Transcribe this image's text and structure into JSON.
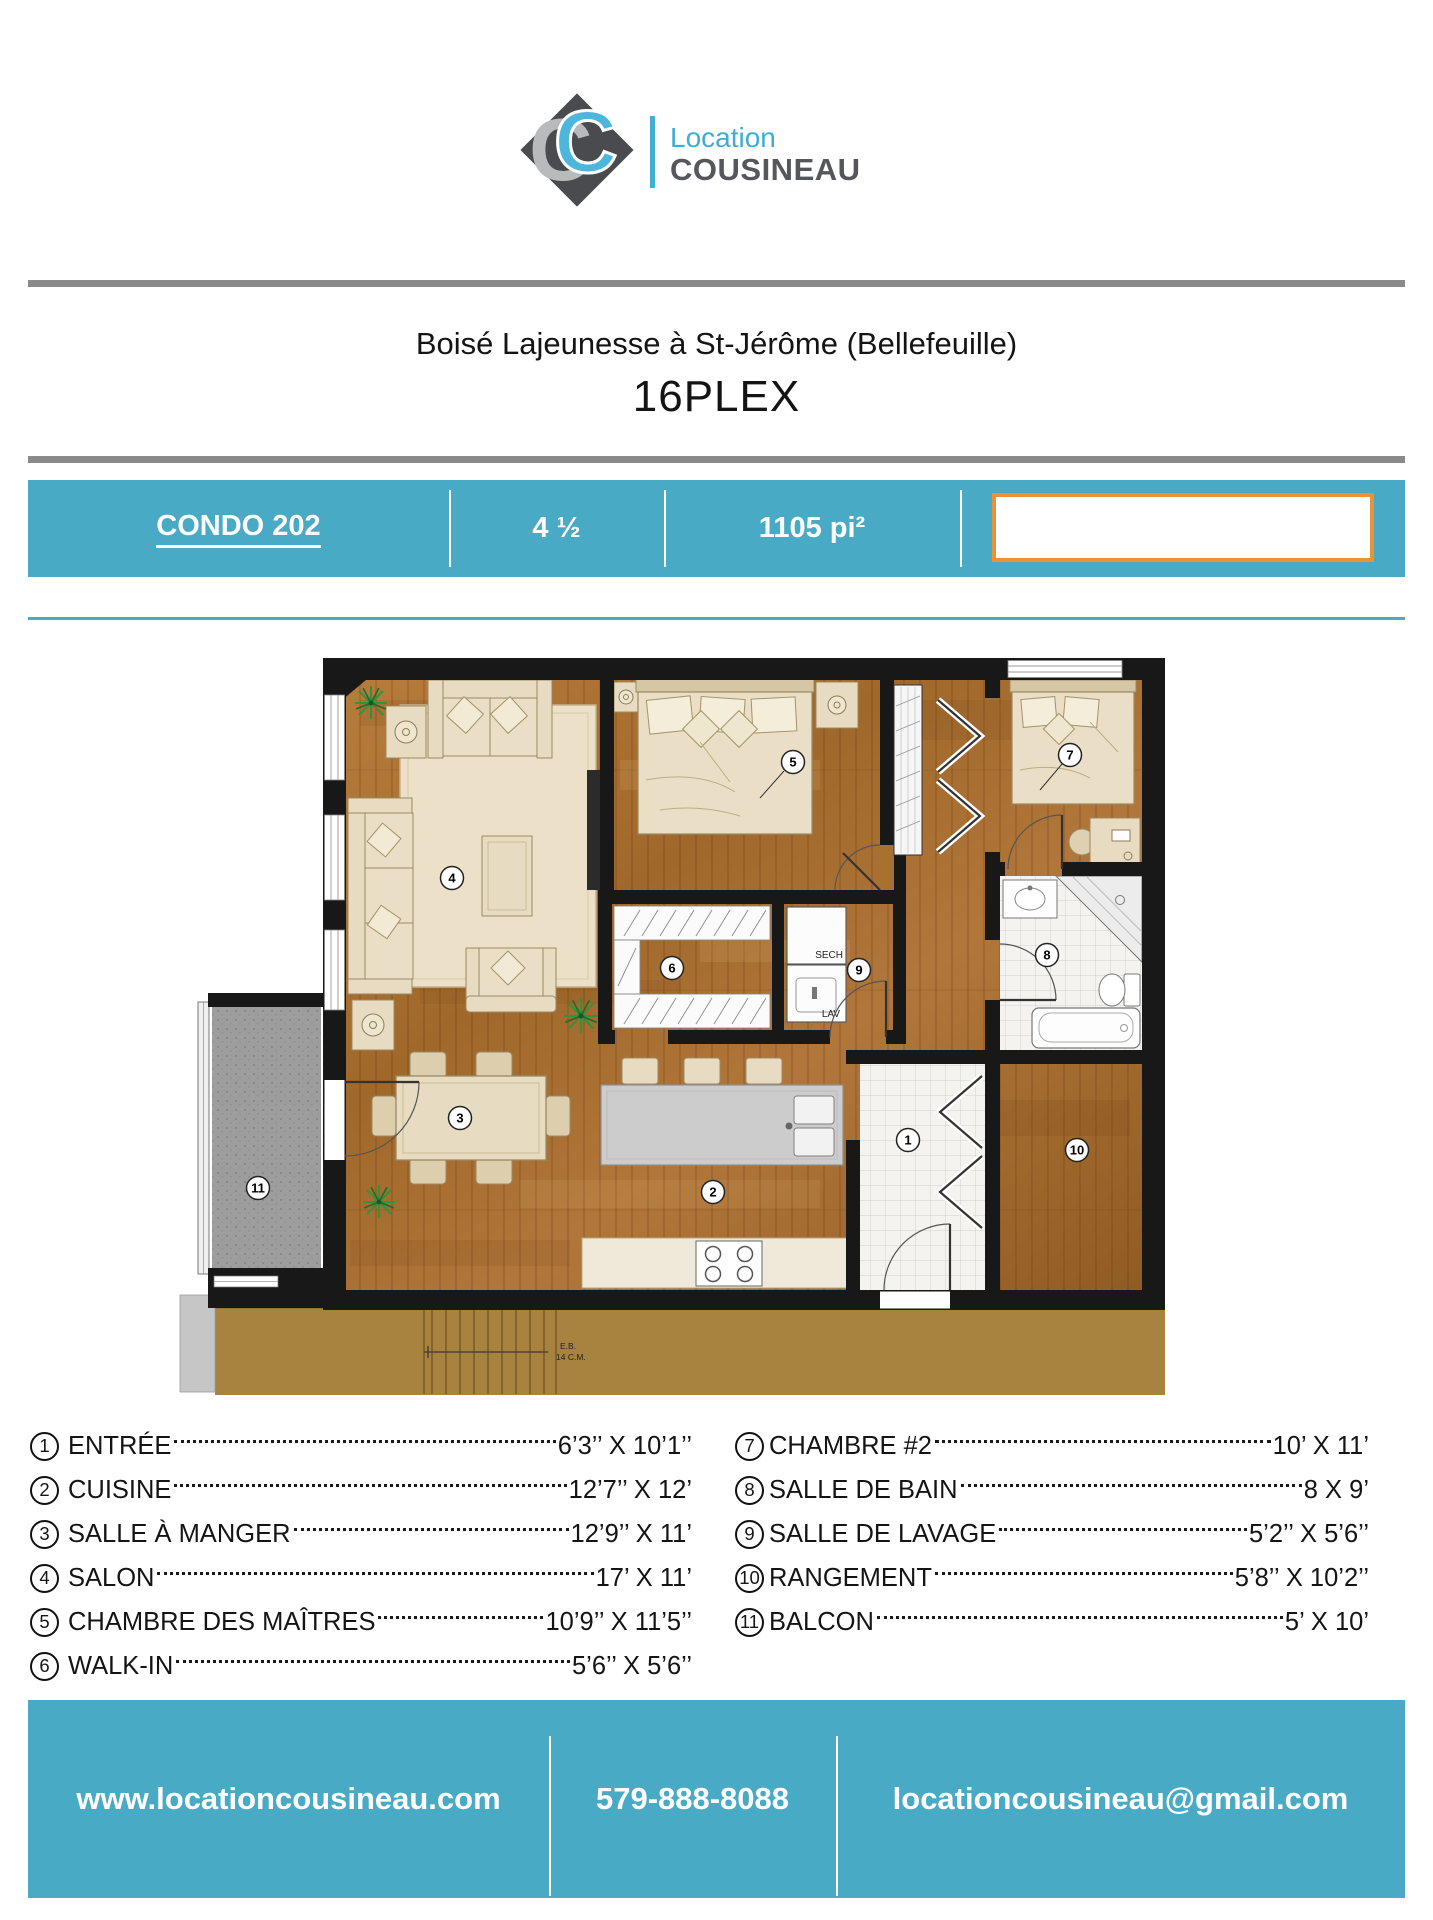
{
  "logo": {
    "monogram_back": "C",
    "monogram_front": "C",
    "brand_line1": "Location",
    "brand_line2": "COUSINEAU"
  },
  "title": {
    "line1": "Boisé Lajeunesse à St-Jérôme (Bellefeuille)",
    "line2": "16PLEX"
  },
  "banner": {
    "unit": "CONDO 202",
    "size": "4 ½",
    "area": "1105 pi²"
  },
  "floorplan": {
    "labels": {
      "dryer": "SECH",
      "washer": "LAV",
      "stair_note_1": "E.B.",
      "stair_note_2": "14 C.M."
    },
    "rooms": [
      {
        "num": "1"
      },
      {
        "num": "2"
      },
      {
        "num": "3"
      },
      {
        "num": "4"
      },
      {
        "num": "5"
      },
      {
        "num": "6"
      },
      {
        "num": "7"
      },
      {
        "num": "8"
      },
      {
        "num": "9"
      },
      {
        "num": "10"
      },
      {
        "num": "11"
      }
    ]
  },
  "legend": {
    "left": [
      {
        "num": "1",
        "name": "ENTRÉE",
        "dims": "6’3’’ X 10’1’’"
      },
      {
        "num": "2",
        "name": "CUISINE",
        "dims": "12’7’’ X 12’"
      },
      {
        "num": "3",
        "name": "SALLE À MANGER",
        "dims": "12’9’’ X 11’"
      },
      {
        "num": "4",
        "name": "SALON",
        "dims": "17’ X 11’"
      },
      {
        "num": "5",
        "name": "CHAMBRE DES MAÎTRES",
        "dims": "10’9’’ X 11’5’’"
      },
      {
        "num": "6",
        "name": "WALK-IN",
        "dims": "5’6’’ X 5’6’’"
      }
    ],
    "right": [
      {
        "num": "7",
        "name": "CHAMBRE #2",
        "dims": "10’ X 11’"
      },
      {
        "num": "8",
        "name": "SALLE DE BAIN",
        "dims": "8 X 9’"
      },
      {
        "num": "9",
        "name": "SALLE DE LAVAGE",
        "dims": "5’2’’ X 5’6’’"
      },
      {
        "num": "10",
        "name": "RANGEMENT",
        "dims": "5’8’’ X 10’2’’"
      },
      {
        "num": "11",
        "name": "BALCON",
        "dims": "5’ X 10’"
      }
    ]
  },
  "footer": {
    "website": "www.locationcousineau.com",
    "phone": "579-888-8088",
    "email": "locationcousineau@gmail.com"
  },
  "colors": {
    "teal": "#48aac4",
    "logo_blue": "#42b0d5",
    "orange_border": "#e8923a",
    "wood": "#a96f30",
    "corridor_tan": "#a8823f"
  }
}
